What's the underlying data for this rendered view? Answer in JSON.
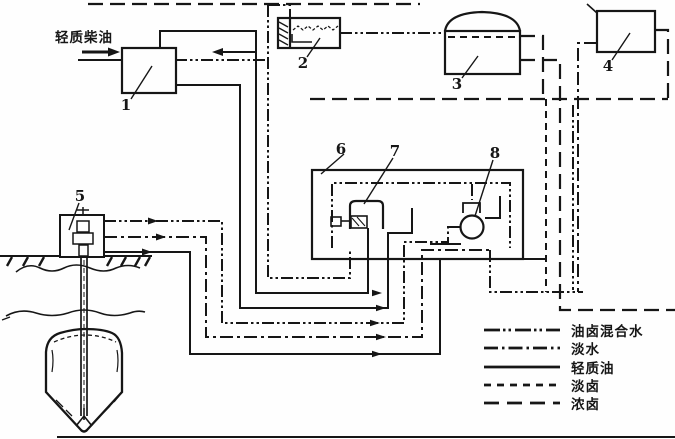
{
  "canvas": {
    "background": "#fefefe",
    "ink": "#161616"
  },
  "diagram": {
    "inlet_label": "轻质柴油",
    "component_labels": {
      "c1": "1",
      "c2": "2",
      "c3": "3",
      "c4": "4",
      "c5": "5",
      "c6": "6",
      "c7": "7",
      "c8": "8"
    },
    "legend": {
      "items": [
        {
          "style": "dash-dot-dot",
          "label": "油卤混合水"
        },
        {
          "style": "dash-dot",
          "label": "淡水"
        },
        {
          "style": "solid",
          "label": "轻质油"
        },
        {
          "style": "dashed",
          "label": "淡卤"
        },
        {
          "style": "long-dash",
          "label": "浓卤"
        }
      ]
    }
  }
}
